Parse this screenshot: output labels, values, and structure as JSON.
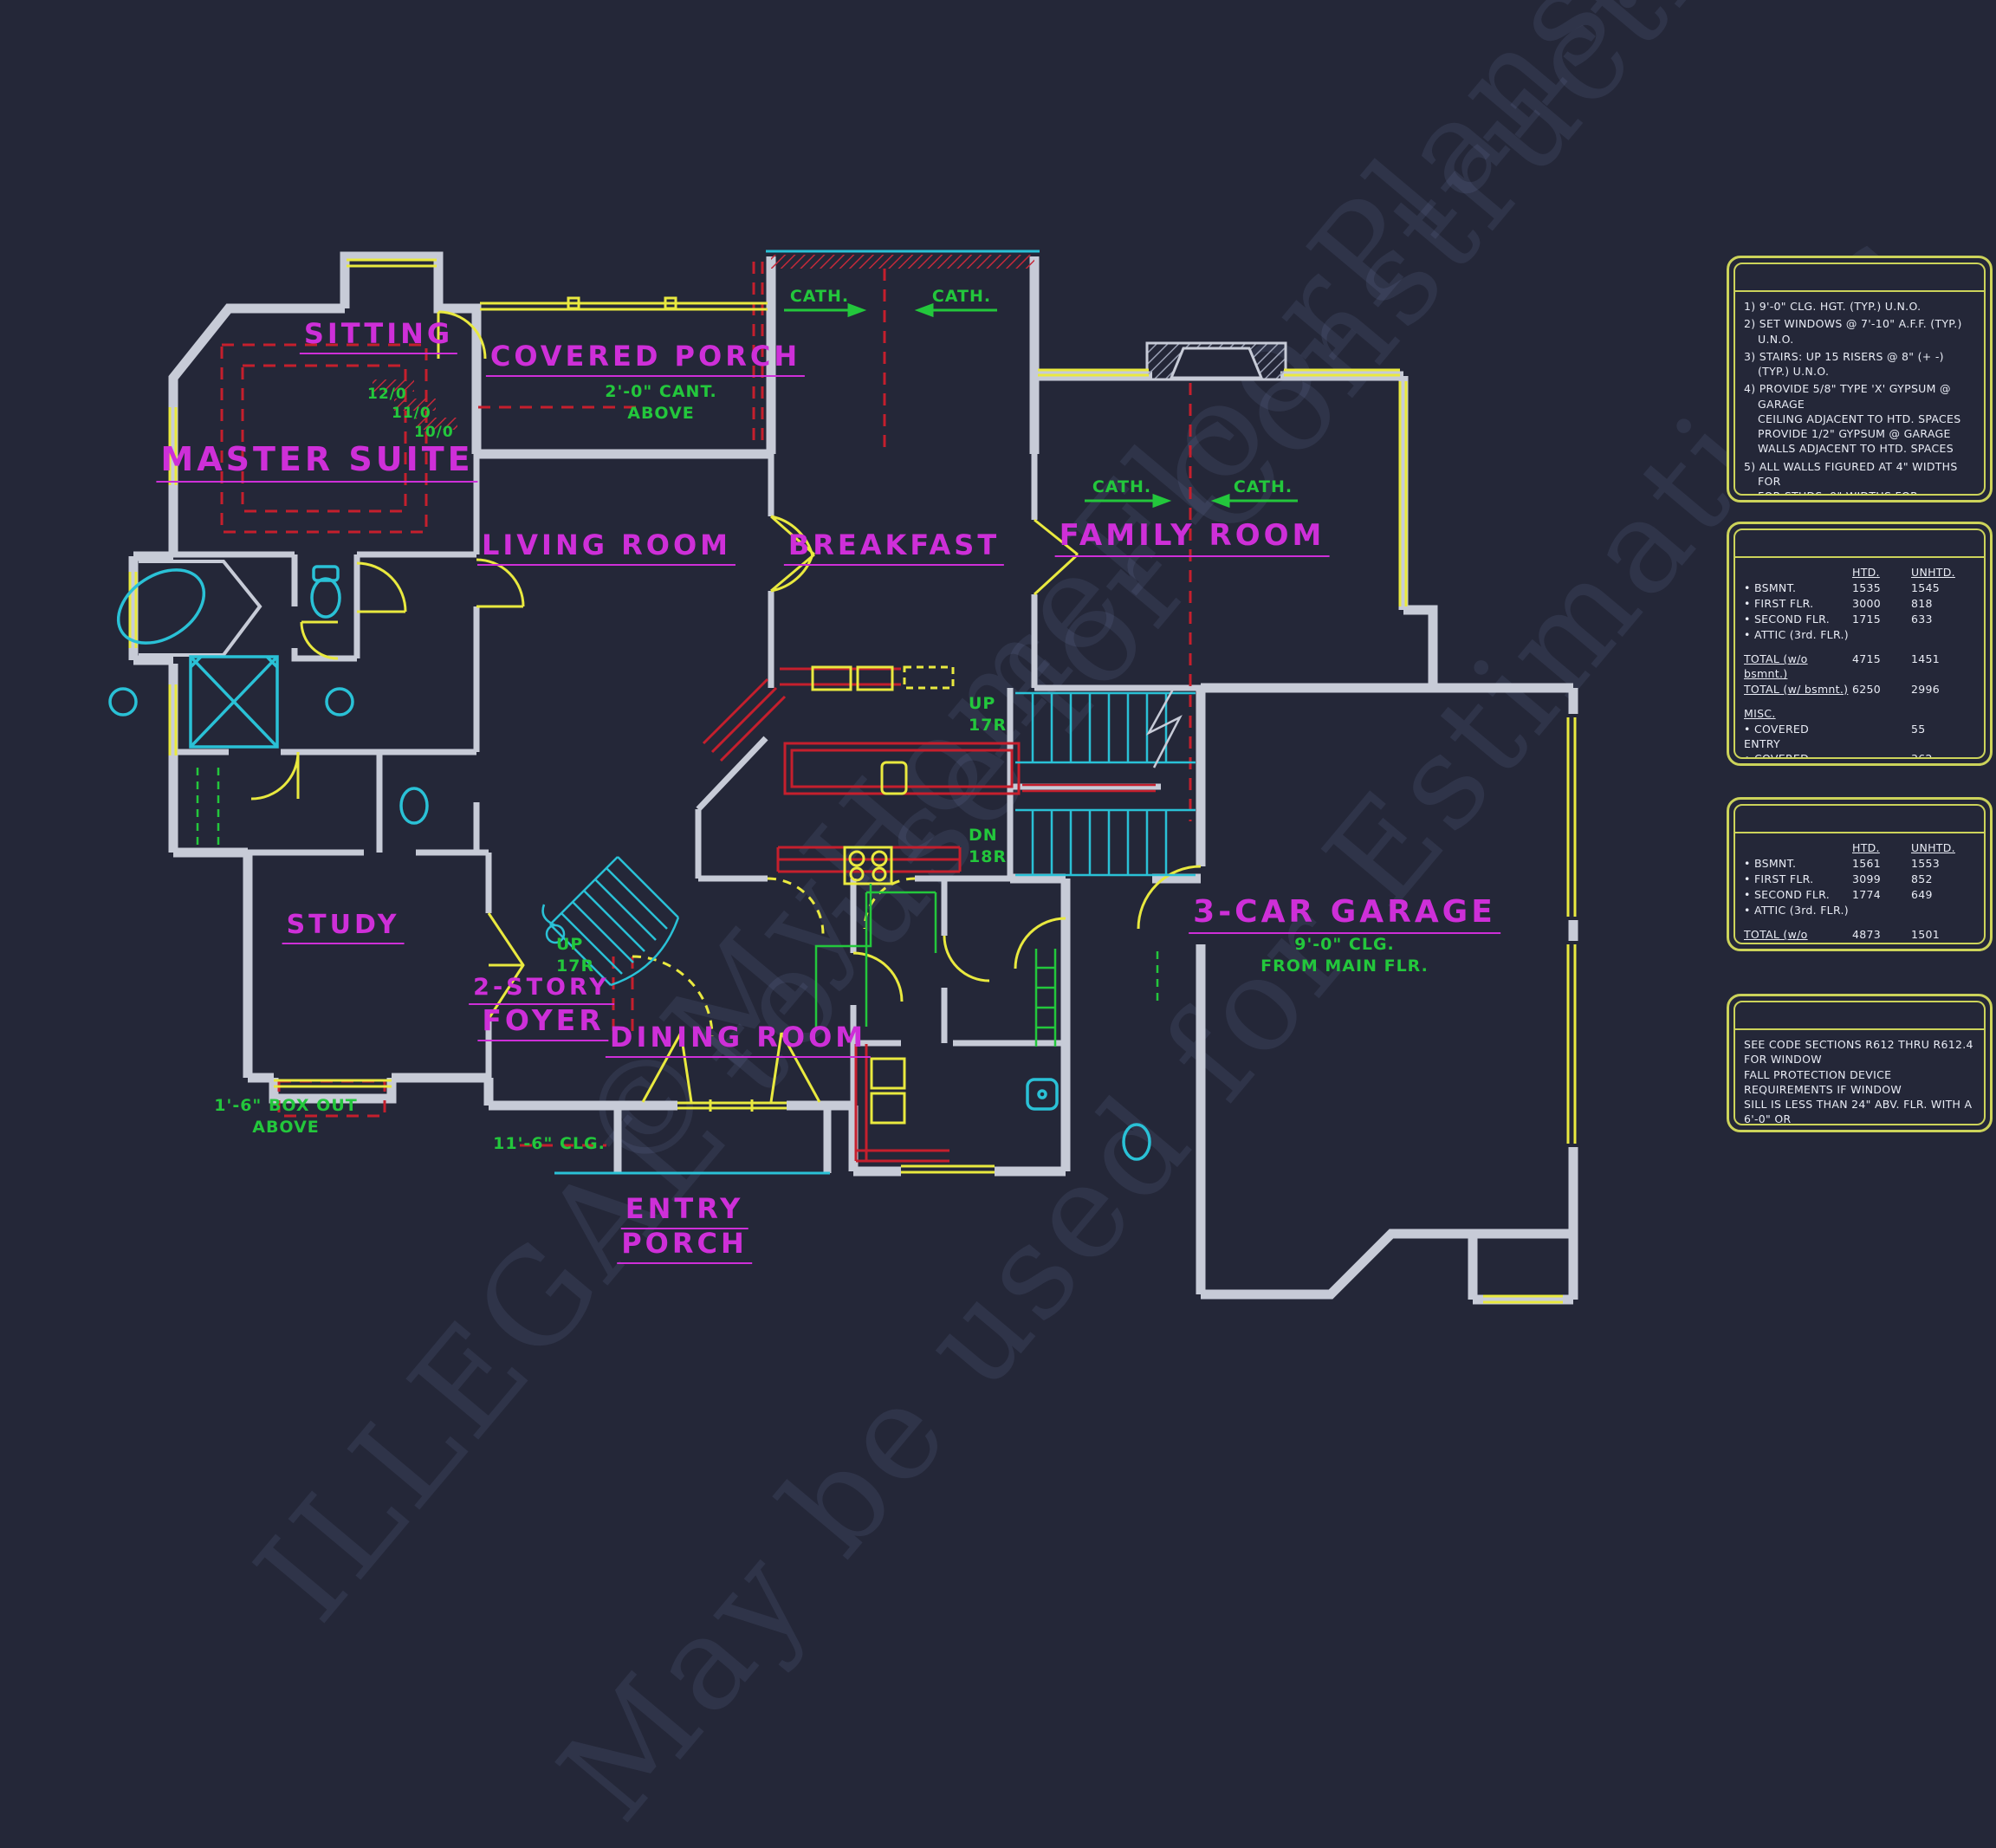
{
  "watermark": {
    "line1": "©MyHomeFloorPlans.com",
    "line2": "ILLEGAL to use for Construction",
    "line3": "May be used for Estimations"
  },
  "rooms": {
    "sitting": "SITTING",
    "master": "MASTER SUITE",
    "covered_porch": "COVERED PORCH",
    "living": "LIVING ROOM",
    "breakfast": "BREAKFAST",
    "family": "FAMILY ROOM",
    "study": "STUDY",
    "foyer_l1": "2-STORY",
    "foyer_l2": "FOYER",
    "dining": "DINING ROOM",
    "entry_l1": "ENTRY",
    "entry_l2": "PORCH",
    "garage": "3-CAR GARAGE"
  },
  "annotations": {
    "cant": "2'-0\" CANT.\nABOVE",
    "garage_clg": "9'-0\" CLG.\nFROM MAIN FLR.",
    "foyer_clg": "11'-6\" CLG.",
    "box_out": "1'-6\" BOX OUT\nABOVE",
    "cath": "CATH.",
    "up_riser": "UP\n17R",
    "dn_riser": "DN\n18R",
    "h12": "12/0",
    "h11": "11/0",
    "h10": "10/0"
  },
  "notes_panel": {
    "items": [
      "1) 9'-0\"  CLG. HGT. (TYP.) U.N.O.",
      "2) SET WINDOWS @ 7'-10\" A.F.F. (TYP.) U.N.O.",
      "3) STAIRS: UP 15 RISERS @ 8\" (+ -)\n(TYP.) U.N.O.",
      "4) PROVIDE 5/8\" TYPE 'X' GYPSUM @ GARAGE\nCEILING ADJACENT TO HTD. SPACES\nPROVIDE 1/2\" GYPSUM @ GARAGE\nWALLS ADJACENT TO HTD. SPACES",
      "5) ALL WALLS FIGURED AT 4\" WIDTHS FOR\nFOR STUDS, 9\" WIDTHS FOR STUD/BRICK\n(TYP.) U.N.O.",
      "6) VERIFY ROUGH OPNG'S,SPECS. FOR CODE\nREQUIREMENTS WITH WINDOW MANUF.",
      "7) SD = SMOKE DETECTOR"
    ]
  },
  "area_table_1": {
    "col_htd": "HTD.",
    "col_unhtd": "UNHTD.",
    "rows": [
      {
        "label": "• BSMNT.",
        "htd": "1535",
        "unhtd": "1545"
      },
      {
        "label": "• FIRST FLR.",
        "htd": "3000",
        "unhtd": "818"
      },
      {
        "label": "• SECOND FLR.",
        "htd": "1715",
        "unhtd": "633"
      },
      {
        "label": "• ATTIC (3rd. FLR.)",
        "htd": "",
        "unhtd": ""
      }
    ],
    "total_rows": [
      {
        "label": "TOTAL (w/o bsmnt.)",
        "htd": "4715",
        "unhtd": "1451"
      },
      {
        "label": "TOTAL (w/ bsmnt.)",
        "htd": "6250",
        "unhtd": "2996"
      }
    ],
    "misc_label": "MISC.",
    "misc_rows": [
      {
        "label": "•  COVERED ENTRY",
        "unhtd": "55"
      },
      {
        "label": "•  COVERED PORCH",
        "unhtd": "362"
      }
    ],
    "extra_bullets": [
      "•",
      "•",
      "•"
    ]
  },
  "area_table_2": {
    "col_htd": "HTD.",
    "col_unhtd": "UNHTD.",
    "rows": [
      {
        "label": "• BSMNT.",
        "htd": "1561",
        "unhtd": "1553"
      },
      {
        "label": "• FIRST FLR.",
        "htd": "3099",
        "unhtd": "852"
      },
      {
        "label": "• SECOND FLR.",
        "htd": "1774",
        "unhtd": "649"
      },
      {
        "label": "• ATTIC (3rd. FLR.)",
        "htd": "",
        "unhtd": ""
      }
    ],
    "total_rows": [
      {
        "label": "TOTAL (w/o bsmnt.)",
        "htd": "4873",
        "unhtd": "1501"
      },
      {
        "label": "TOTAL (w/ bsmnt.)",
        "htd": "6434",
        "unhtd": "3054"
      }
    ]
  },
  "code_panel": {
    "text": "SEE CODE SECTIONS R612 THRU R612.4 FOR WINDOW\nFALL PROTECTION DEVICE REQUIREMENTS IF WINDOW\nSILL IS LESS THAN 24\" ABV. FLR. WITH A 6'-0\" OR\nGREATER DISTANCE TO A SURFACE OUTSIDE AND\nBELOW THE WINDOW."
  }
}
